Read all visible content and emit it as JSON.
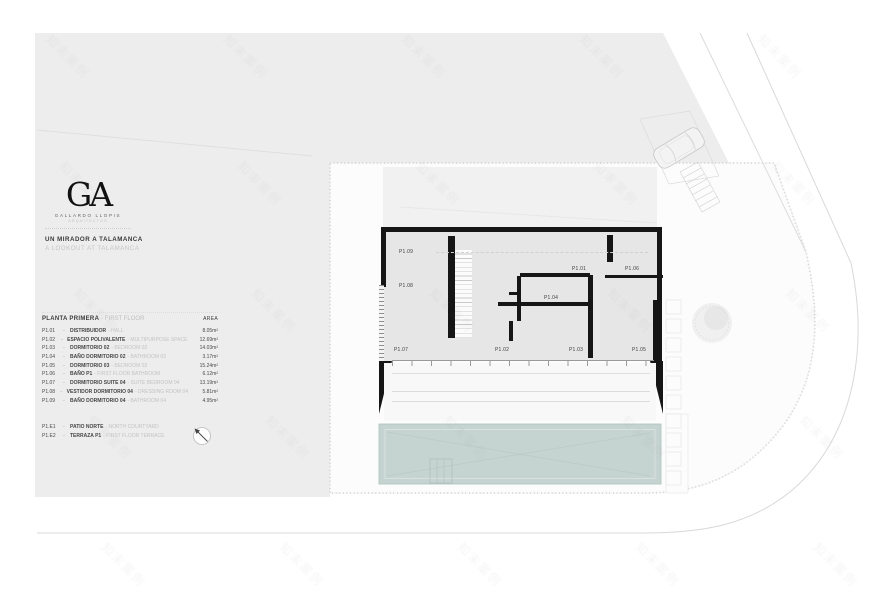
{
  "branding": {
    "logo_monogram": "GA",
    "studio_name": "GALLARDO LLOPIS",
    "studio_subtitle": "ARQUITECTOS",
    "project_title_es": "UN MIRADOR A TALAMANCA",
    "project_title_en": "A LOOKOUT AT TALAMANCA"
  },
  "legend": {
    "title_es": "PLANTA PRIMERA",
    "title_en": "- FIRST FLOOR",
    "area_header": "AREA",
    "rows": [
      {
        "code": "P1.01",
        "sep": "-",
        "es": "DISTRIBUIDOR",
        "en": "- HALL",
        "area": "8.05m²"
      },
      {
        "code": "P1.02",
        "sep": "-",
        "es": "ESPACIO POLIVALENTE",
        "en": "- MULTIPURPOSE SPACE",
        "area": "12.69m²"
      },
      {
        "code": "P1.03",
        "sep": "-",
        "es": "DORMITORIO 02",
        "en": "- BEDROOM 02",
        "area": "14.03m²"
      },
      {
        "code": "P1.04",
        "sep": "-",
        "es": "BAÑO DORMITORIO 02",
        "en": "- BATHROOM 02",
        "area": "3.17m²"
      },
      {
        "code": "P1.05",
        "sep": "-",
        "es": "DORMITORIO 03",
        "en": "- BEDROOM 03",
        "area": "15.24m²"
      },
      {
        "code": "P1.06",
        "sep": "-",
        "es": "BAÑO P1",
        "en": "- FIRST FLOOR BATHROOM",
        "area": "6.12m²"
      },
      {
        "code": "P1.07",
        "sep": "-",
        "es": "DORMITORIO SUITE 04",
        "en": "- SUITE BEDROOM 04",
        "area": "13.19m²"
      },
      {
        "code": "P1.08",
        "sep": "-",
        "es": "VESTIDOR DORMITORIO 04",
        "en": "- DRESSING ROOM 04",
        "area": "5.81m²"
      },
      {
        "code": "P1.09",
        "sep": "-",
        "es": "BAÑO DORMITORIO 04",
        "en": "- BATHROOM 04",
        "area": "4.95m²"
      }
    ],
    "extra_rows": [
      {
        "code": "P1.E1",
        "sep": "-",
        "es": "PATIO NORTE",
        "en": "- NORTH COURTYARD",
        "area": ""
      },
      {
        "code": "P1.E2",
        "sep": "-",
        "es": "TERRAZA P1",
        "en": "- FIRST FLOOR TERRACE",
        "area": ""
      }
    ]
  },
  "plan": {
    "room_labels": [
      {
        "code": "P1.09",
        "x": 399,
        "y": 249
      },
      {
        "code": "P1.08",
        "x": 399,
        "y": 283
      },
      {
        "code": "P1.01",
        "x": 572,
        "y": 266
      },
      {
        "code": "P1.06",
        "x": 625,
        "y": 266
      },
      {
        "code": "P1.04",
        "x": 544,
        "y": 295
      },
      {
        "code": "P1.07",
        "x": 394,
        "y": 347
      },
      {
        "code": "P1.02",
        "x": 495,
        "y": 347
      },
      {
        "code": "P1.03",
        "x": 569,
        "y": 347
      },
      {
        "code": "P1.05",
        "x": 632,
        "y": 347
      }
    ]
  },
  "watermark": {
    "text": "知末案例"
  },
  "colors": {
    "site_gray": "#ededed",
    "wall_black": "#161616",
    "pool_fill": "#c6d4d1",
    "text_dark": "#3a3a3a",
    "text_muted": "#c3c3c3"
  }
}
